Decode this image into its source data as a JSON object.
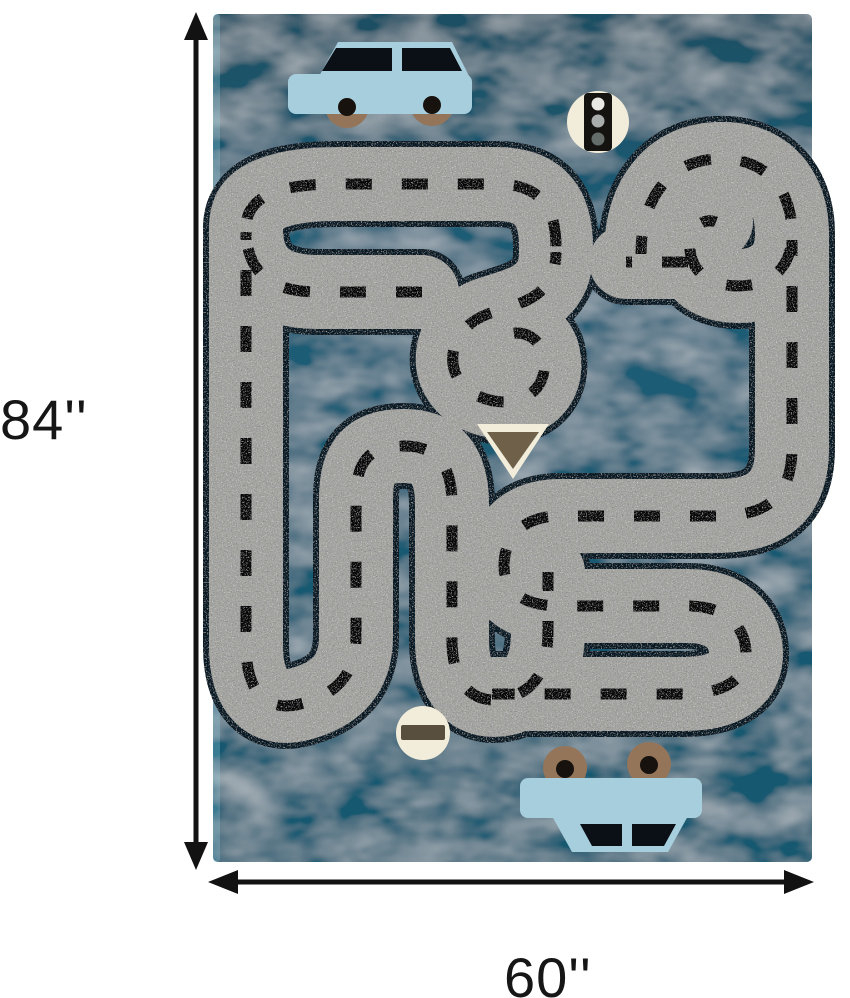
{
  "image": {
    "subject": "Kids road-play area rug product photo with dimension arrows"
  },
  "dimensions": {
    "height": "84''",
    "width": "60''"
  },
  "rug": {
    "signs": [
      {
        "name": "traffic-light-sign"
      },
      {
        "name": "yield-sign"
      },
      {
        "name": "no-entry-sign"
      }
    ],
    "cars": [
      {
        "name": "top-car",
        "style": "upright sedan"
      },
      {
        "name": "bottom-car",
        "style": "upside-down sedan"
      }
    ]
  },
  "colors": {
    "page-bg": "#ffffff",
    "rug-teal": "#1d5c75",
    "rug-teal-dark": "#1f4f63",
    "rug-teal-deep": "#16586f",
    "road-gray": "#a3a3a0",
    "road-outline": "#0d1b26",
    "dash-black": "#0b0b0b",
    "car-blue": "#a7cedd",
    "car-window": "#0a1016",
    "wheel-brown": "#94755a",
    "wheel-hub": "#17120e",
    "sign-cream": "#f2edda",
    "yield-brown": "#6e6049",
    "noentry-bar": "#584f3f",
    "light-top": "#e8e8e4",
    "light-mid": "#a9aeac",
    "light-bottom": "#646d6a",
    "arrow-black": "#121212"
  }
}
